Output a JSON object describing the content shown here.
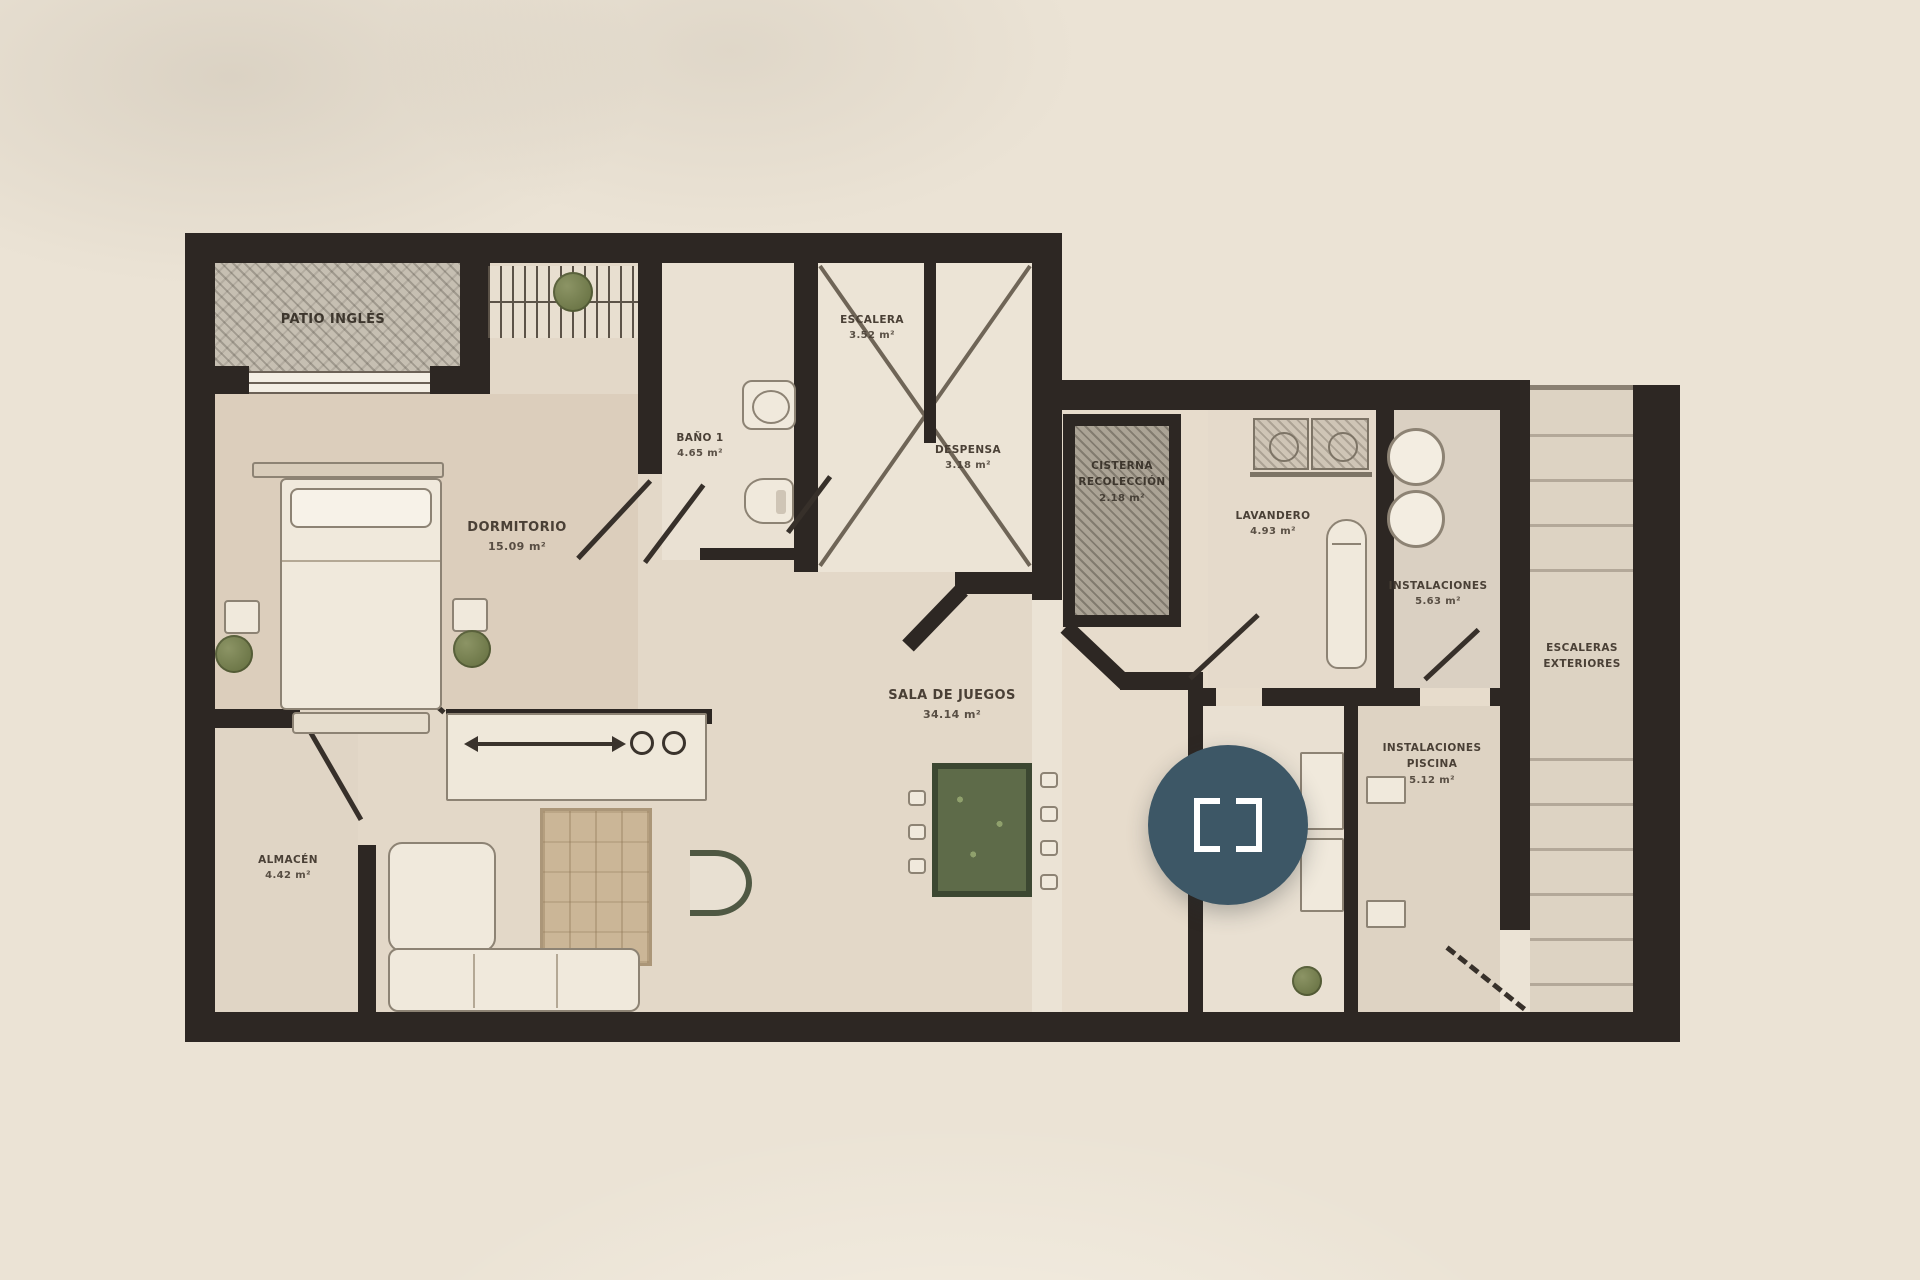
{
  "plan": {
    "rooms": {
      "patio": {
        "name": "PATIO INGLÉS"
      },
      "dormitorio": {
        "name": "DORMITORIO",
        "area": "15.09 m²"
      },
      "bano1": {
        "name": "BAÑO 1",
        "area": "4.65 m²"
      },
      "escalera": {
        "name": "ESCALERA",
        "area": "3.52 m²"
      },
      "despensa": {
        "name": "DESPENSA",
        "area": "3.18 m²"
      },
      "cisterna": {
        "name": "CISTERNA",
        "name2": "RECOLECCIÓN",
        "area": "2.18 m²"
      },
      "lavandero": {
        "name": "LAVANDERO",
        "area": "4.93 m²"
      },
      "instalaciones": {
        "name": "INSTALACIONES",
        "area": "5.63 m²"
      },
      "sala": {
        "name": "SALA DE JUEGOS",
        "area": "34.14 m²"
      },
      "almacen": {
        "name": "ALMACÉN",
        "area": "4.42 m²"
      },
      "instalaciones_piscina": {
        "name": "INSTALACIONES",
        "name2": "PISCINA",
        "area": "5.12 m²"
      },
      "escaleras_exteriores": {
        "name": "ESCALERAS",
        "name2": "EXTERIORES"
      }
    },
    "controls": {
      "fullscreen_icon": "expand-brackets"
    },
    "colors": {
      "wall": "#2d2723",
      "background": "#ebe3d5",
      "floor": "#e4d9c9",
      "accent_button": "#3d5766",
      "table_green": "#5e6b49"
    }
  }
}
